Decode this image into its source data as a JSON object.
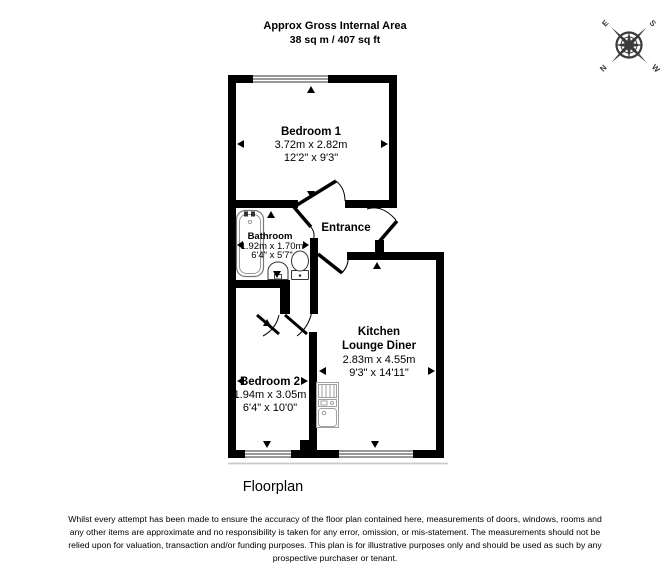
{
  "header": {
    "line1": "Approx Gross Internal Area",
    "line2": "38 sq m / 407 sq ft"
  },
  "compass": {
    "letters": {
      "n": "N",
      "e": "E",
      "s": "S",
      "w": "W"
    }
  },
  "rooms": {
    "bedroom1": {
      "name": "Bedroom 1",
      "metric": "3.72m x 2.82m",
      "imperial": "12'2\" x 9'3\""
    },
    "bathroom": {
      "name": "Bathroom",
      "metric": "1.92m x 1.70m",
      "imperial": "6'4\" x 5'7\""
    },
    "entrance": {
      "name": "Entrance"
    },
    "kitchen_lounge": {
      "name_line1": "Kitchen",
      "name_line2": "Lounge Diner",
      "metric": "2.83m x 4.55m",
      "imperial": "9'3\" x 14'11\""
    },
    "bedroom2": {
      "name": "Bedroom 2",
      "metric": "1.94m x 3.05m",
      "imperial": "6'4\" x 10'0\""
    }
  },
  "caption": "Floorplan",
  "disclaimer": {
    "lines": [
      "Whilst every attempt has been made to ensure the accuracy of the floor plan contained here, measurements of doors, windows, rooms and",
      "any other items are approximate and no responsibility is taken for any error, omission, or mis-statement. The measurements should not be",
      "relied upon for valuation, transaction and/or funding purposes. This plan is for illustrative purposes only and should be used as such by any",
      "prospective purchaser or tenant."
    ]
  },
  "colors": {
    "wall": "#000000",
    "background": "#ffffff",
    "compass": "#3a3a3a",
    "fixture_gray": "#a0a0a0"
  }
}
